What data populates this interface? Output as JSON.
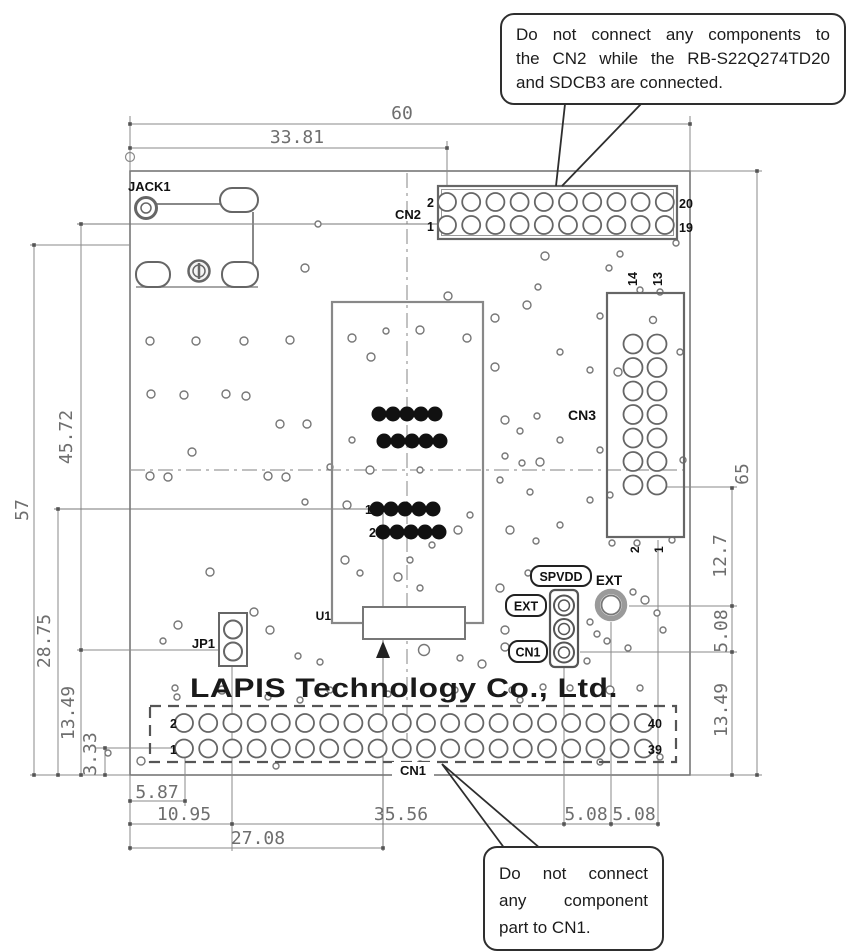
{
  "callouts": {
    "cn2_note": {
      "lines": [
        "Do not connect any components to",
        "the CN2 while the RB-S22Q274TD20",
        "and SDCB3 are connected."
      ]
    },
    "cn1_note": {
      "lines": [
        "Do not connect",
        "any component",
        "part to CN1."
      ]
    }
  },
  "silkscreen": {
    "company": "LAPIS Technology Co., Ltd."
  },
  "refdes": {
    "jack": "JACK1",
    "cn2": "CN2",
    "cn3": "CN3",
    "cn1": "CN1",
    "jp1": "JP1",
    "u1": "U1",
    "ext": "EXT"
  },
  "net_labels": {
    "spvdd": "SPVDD",
    "ext": "EXT",
    "cn1": "CN1"
  },
  "pin_numbers": {
    "cn2": {
      "top_left": "2",
      "bottom_left": "1",
      "top_right": "20",
      "bottom_right": "19"
    },
    "cn1": {
      "top_left": "2",
      "bottom_left": "1",
      "top_right": "40",
      "bottom_right": "39"
    },
    "cn3": {
      "top_left": "14",
      "top_right": "13",
      "bottom_left": "2",
      "bottom_right": "1"
    },
    "u1": {
      "row1": "1",
      "row2": "2"
    }
  },
  "dimensions_mm": {
    "top": {
      "total": "60",
      "to_cn2_pin1": "33.81"
    },
    "left": {
      "total": "57",
      "cn2pin_to_jp1": "45.72",
      "u1pin_to_edge": "28.75",
      "jp1_to_edge": "13.49",
      "cn1pin_to_edge": "3.33"
    },
    "right": {
      "total": "65",
      "cn3_to_ext": "12.7",
      "ext_to_hdr": "5.08",
      "hdr_to_edge": "13.49"
    },
    "bottom": {
      "edge_to_cn1pin": "5.87",
      "edge_to_jp1": "10.95",
      "jp1_to_hdr": "35.56",
      "hdr_to_ext": "5.08",
      "ext_to_cn3": "5.08",
      "edge_to_u1pin": "27.08"
    }
  },
  "colors": {
    "line": "#8a8a8a",
    "pad": "#666666",
    "text": "#1a1a1a",
    "dim_text": "#6e6e6e"
  }
}
